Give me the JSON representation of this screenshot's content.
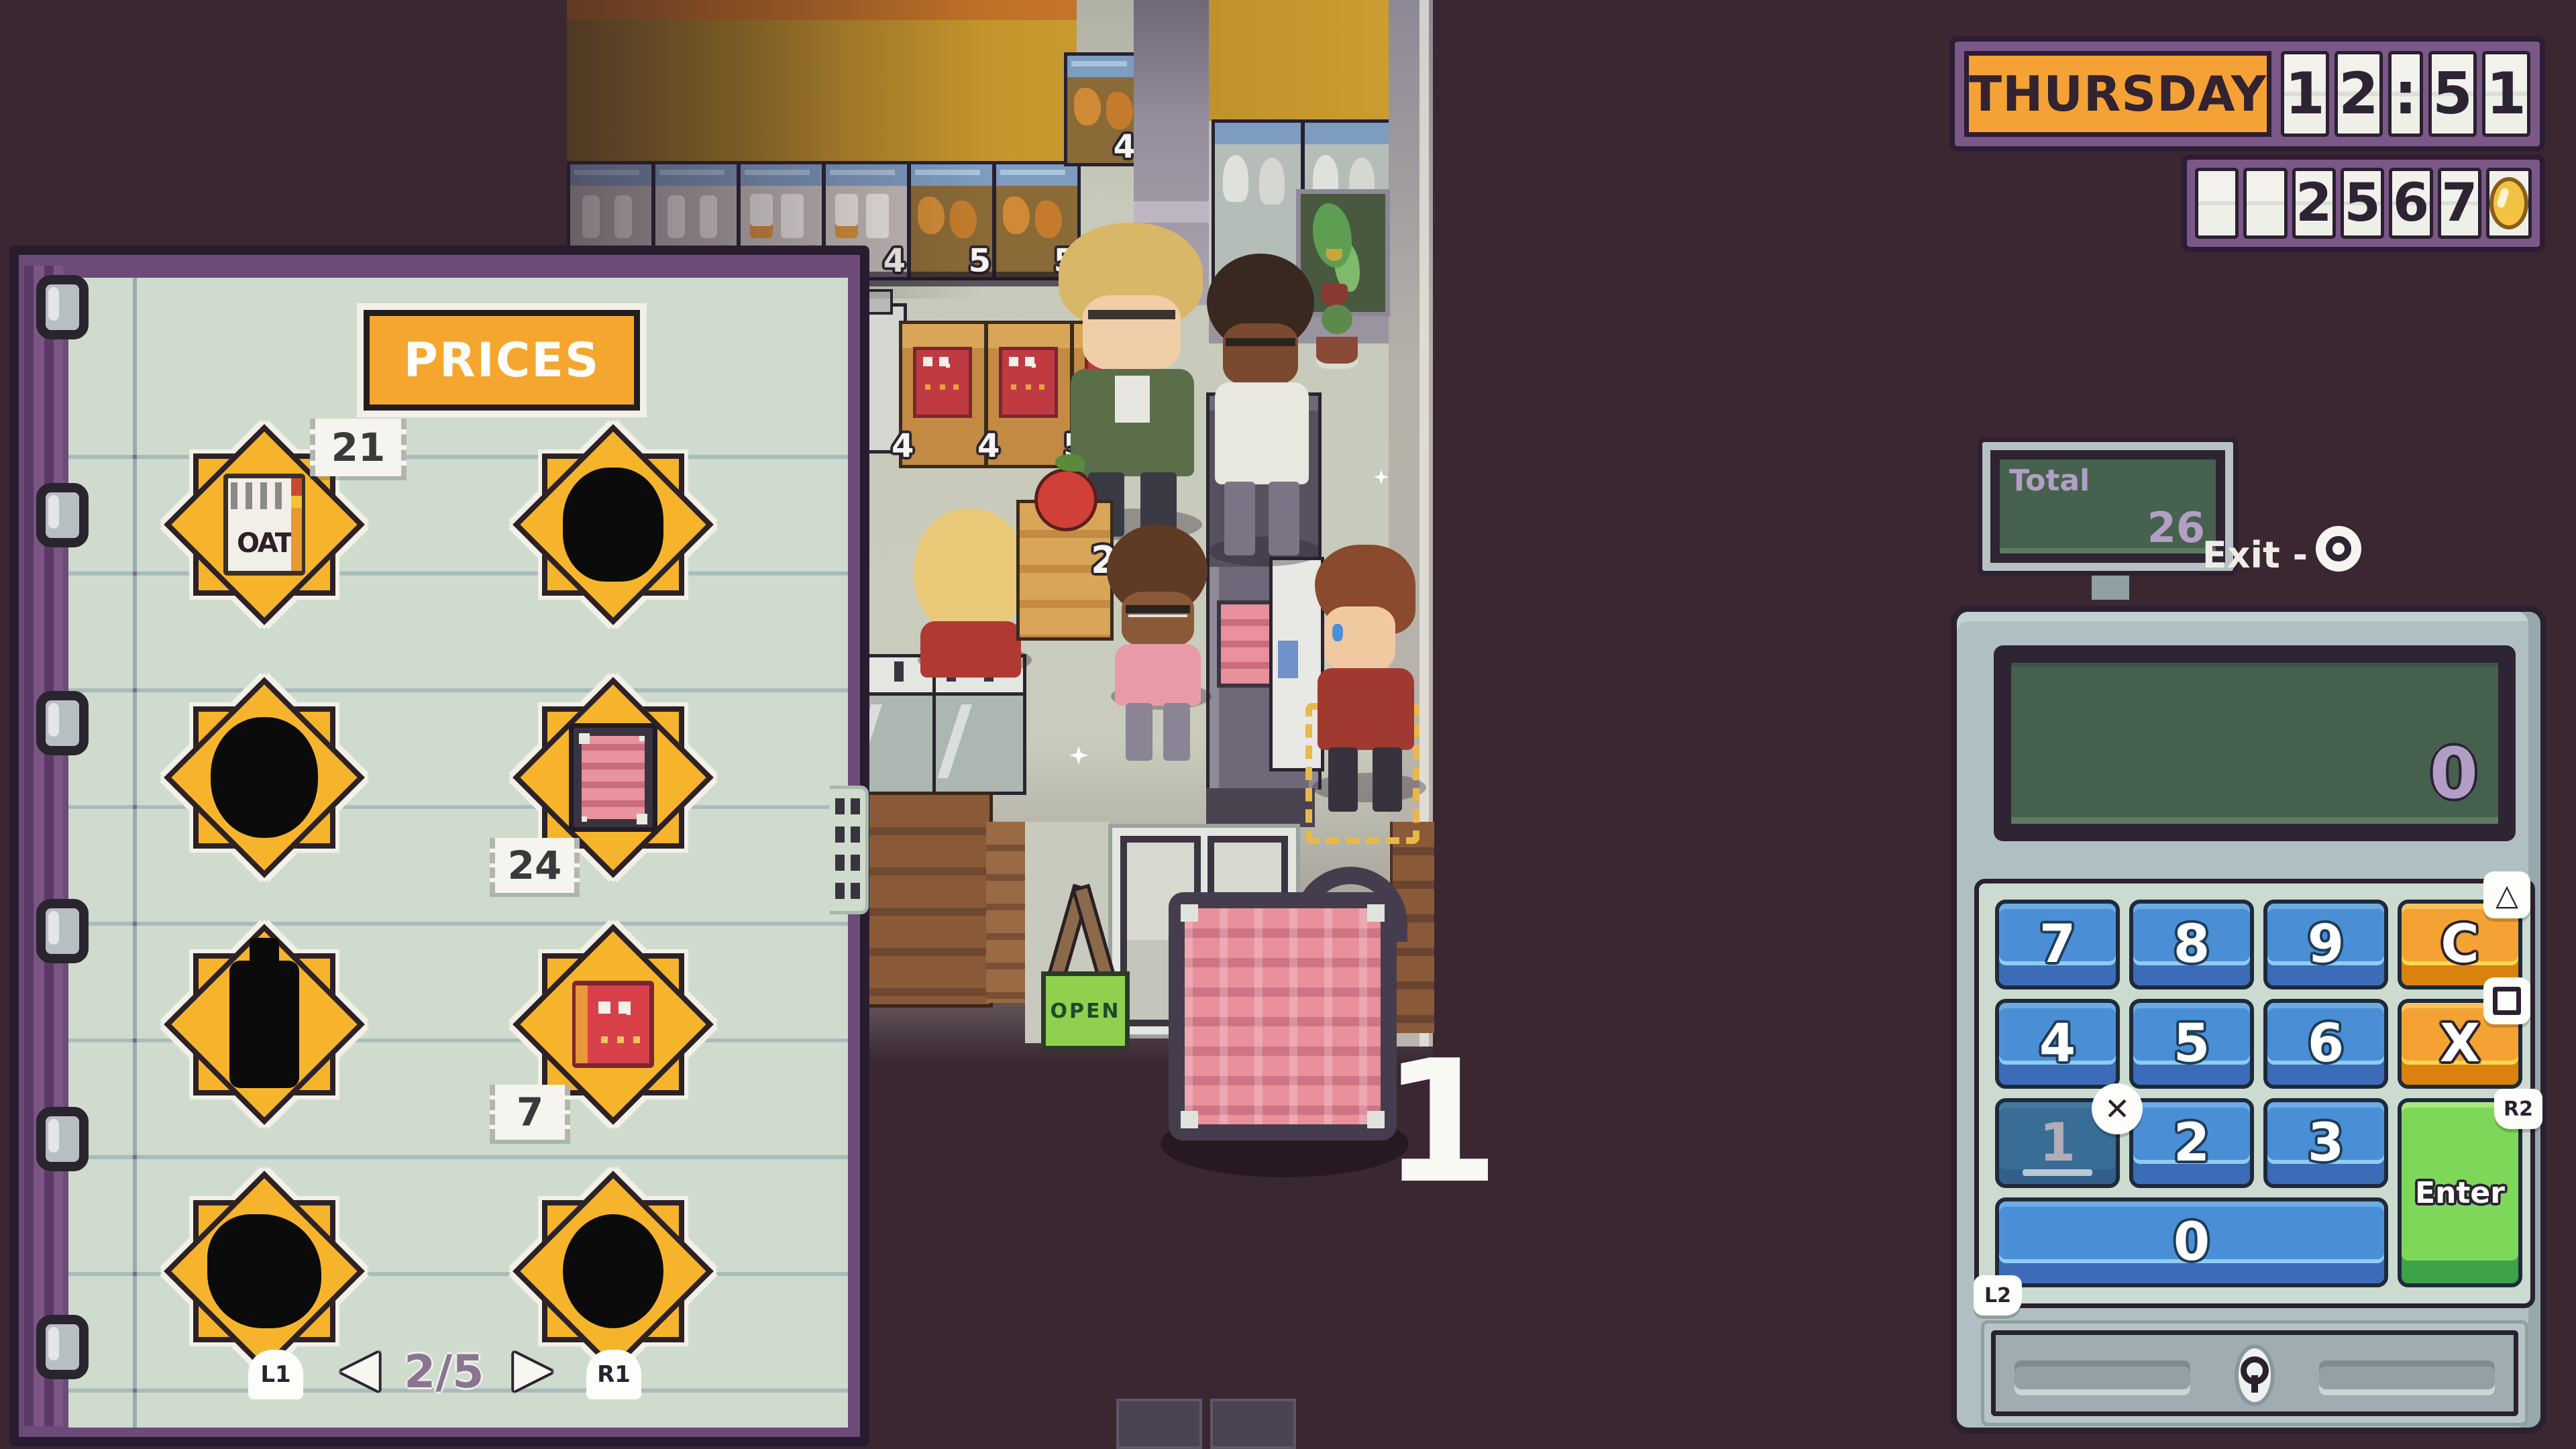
{
  "colors": {
    "bg_maroon": "#3a2731",
    "panel_purple": "#7b5887",
    "accent_orange": "#f4a233",
    "paper_green": "#cfdccd",
    "key_blue": "#4a8fd6",
    "enter_green": "#7fd75a",
    "screen_green": "#46604e",
    "star_yellow": "#f6b42c"
  },
  "hud": {
    "day": "THURSDAY",
    "time_cells": [
      "1",
      "2",
      ":",
      "5",
      "1"
    ],
    "money_value": "2567",
    "money_cells": [
      "",
      "",
      "2",
      "5",
      "6",
      "7"
    ]
  },
  "monitor": {
    "label": "Total",
    "value": "26"
  },
  "exit": {
    "label": "Exit -"
  },
  "register": {
    "screen_value": "0",
    "keys": {
      "seven": "7",
      "eight": "8",
      "nine": "9",
      "clear": "C",
      "four": "4",
      "five": "5",
      "six": "6",
      "multiply": "X",
      "one": "1",
      "two": "2",
      "three": "3",
      "zero": "0",
      "enter": "Enter"
    },
    "shoulder_badges": {
      "r2": "R2",
      "l2": "L2"
    },
    "button_glyphs": {
      "triangle": "△",
      "cross": "✕"
    }
  },
  "notebook": {
    "title": "PRICES",
    "page_indicator": "2/5",
    "nav": {
      "prev_badge": "L1",
      "next_badge": "R1",
      "prev_arrow": "◀",
      "next_arrow": "▶"
    },
    "items": [
      {
        "name": "oat cereal box",
        "icon_text": "OAT",
        "price": "21"
      },
      {
        "name": "unknown item silhouette"
      },
      {
        "name": "unknown item silhouette"
      },
      {
        "name": "bacon pack",
        "price": "24"
      },
      {
        "name": "unknown bottle silhouette"
      },
      {
        "name": "cracker box",
        "price": "7"
      },
      {
        "name": "unknown item silhouette"
      },
      {
        "name": "unknown item silhouette"
      }
    ]
  },
  "scene": {
    "shelf_row_labels": [
      "5",
      "5",
      "4",
      "4",
      "5",
      "5"
    ],
    "shelf_upper_label": "4",
    "alcove_shelf_labels": [
      "5",
      "5"
    ],
    "crate_labels": [
      "4",
      "4",
      "5"
    ],
    "produce_crate_label": "2",
    "quantity_popup": "1",
    "open_sign": "OPEN"
  }
}
